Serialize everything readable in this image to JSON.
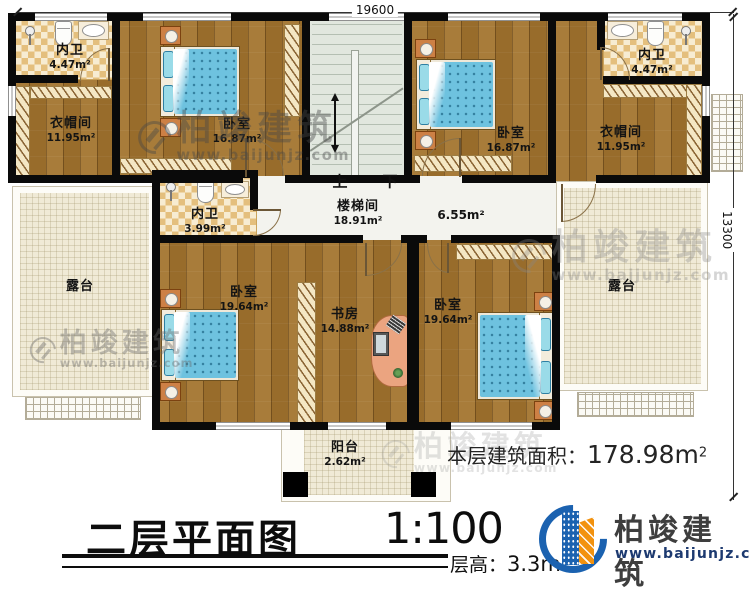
{
  "dimensions": {
    "top": "19600",
    "right": "13300"
  },
  "stairs": {
    "up": "上",
    "down": "下"
  },
  "rooms": {
    "bath_tl": {
      "name": "内卫",
      "area": "4.47m²"
    },
    "cloak_l": {
      "name": "衣帽间",
      "area": "11.95m²"
    },
    "bed_tl": {
      "name": "卧室",
      "area": "16.87m²"
    },
    "stairwell": {
      "name": "楼梯间",
      "area": "18.91m²"
    },
    "hall": {
      "area": "6.55m²"
    },
    "bed_tr": {
      "name": "卧室",
      "area": "16.87m²"
    },
    "bath_tr": {
      "name": "内卫",
      "area": "4.47m²"
    },
    "cloak_r": {
      "name": "衣帽间",
      "area": "11.95m²"
    },
    "bath_mid": {
      "name": "内卫",
      "area": "3.99m²"
    },
    "terrace_l": {
      "name": "露台"
    },
    "terrace_r": {
      "name": "露台"
    },
    "bed_bl": {
      "name": "卧室",
      "area": "19.64m²"
    },
    "study": {
      "name": "书房",
      "area": "14.88m²"
    },
    "bed_br": {
      "name": "卧室",
      "area": "19.64m²"
    },
    "balcony": {
      "name": "阳台",
      "area": "2.62m²"
    }
  },
  "titleblock": {
    "title": "二层平面图",
    "scale": "1:100",
    "floor_height_label": "层高：",
    "floor_height_value": "3.3m",
    "floor_area_label": "本层建筑面积：",
    "floor_area_value": "178.98m",
    "floor_area_sup": "2"
  },
  "logo": {
    "name": "柏竣建筑",
    "url": "www.baijunjz.com"
  },
  "watermark": {
    "brand": "柏竣建筑",
    "url": "www.baijunjz.com"
  }
}
